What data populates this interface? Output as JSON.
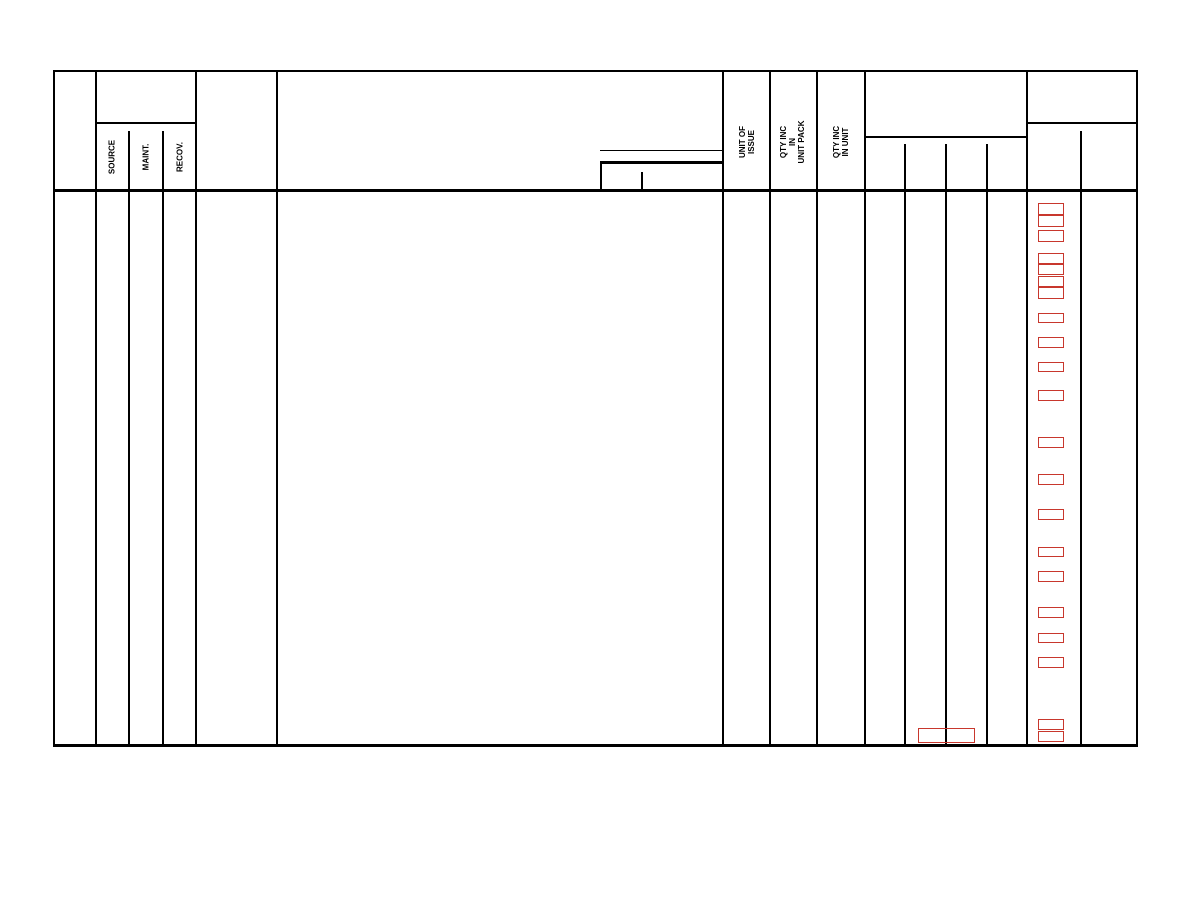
{
  "header": {
    "smr": {
      "source": "SOURCE",
      "maint": "MAINT.",
      "recov": "RECOV."
    },
    "unit_of_issue": "UNIT OF\nISSUE",
    "qty_inc_in_unit_pack": "QTY INC\nIN\nUNIT PACK",
    "qty_inc_in_unit": "QTY INC\nIN UNIT"
  },
  "colors": {
    "line": "#000000",
    "mark_red": "#c8372d",
    "page_background": "#ffffff"
  },
  "red_marks": {
    "column": {
      "x": 1038,
      "width": 26
    },
    "items": [
      {
        "y": 203,
        "h": 12
      },
      {
        "y": 215,
        "h": 12
      },
      {
        "y": 230,
        "h": 12
      },
      {
        "y": 253,
        "h": 11
      },
      {
        "y": 264,
        "h": 11
      },
      {
        "y": 276,
        "h": 11
      },
      {
        "y": 287,
        "h": 12
      },
      {
        "y": 313,
        "h": 10
      },
      {
        "y": 337,
        "h": 11
      },
      {
        "y": 362,
        "h": 10
      },
      {
        "y": 390,
        "h": 11
      },
      {
        "y": 437,
        "h": 11
      },
      {
        "y": 474,
        "h": 11
      },
      {
        "y": 509,
        "h": 11
      },
      {
        "y": 547,
        "h": 10
      },
      {
        "y": 571,
        "h": 11
      },
      {
        "y": 607,
        "h": 11
      },
      {
        "y": 633,
        "h": 10
      },
      {
        "y": 657,
        "h": 11
      },
      {
        "y": 719,
        "h": 11
      },
      {
        "y": 731,
        "h": 11
      }
    ],
    "wide_mark": {
      "x": 918,
      "y": 728,
      "w": 57,
      "h": 15
    }
  }
}
